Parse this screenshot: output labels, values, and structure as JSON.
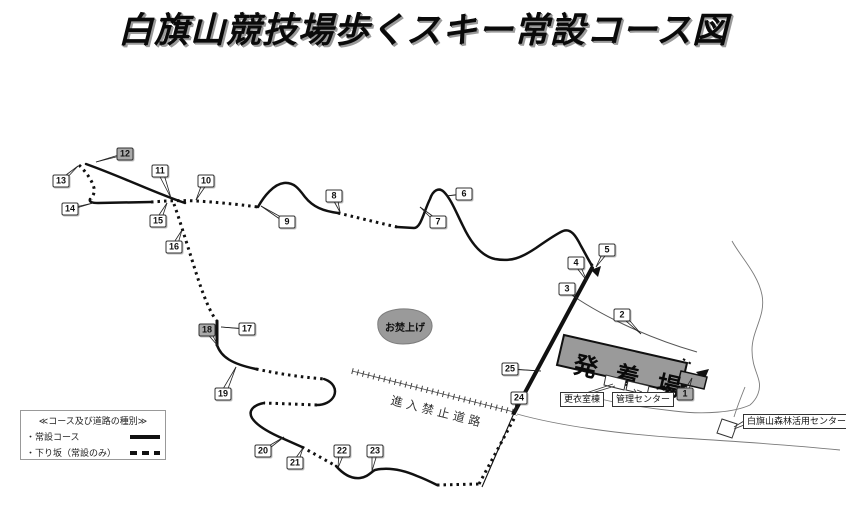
{
  "title": "白旗山競技場歩くスキー常設コース図",
  "legend": {
    "header": "≪コース及び道路の種別≫",
    "items": [
      {
        "label": "・常設コース",
        "style": "solid"
      },
      {
        "label": "・下り坂（常設のみ）",
        "style": "dashed"
      }
    ]
  },
  "labels": {
    "departure_area": "発 着 場",
    "bonfire": "お焚上げ",
    "no_entry_road": "進入禁止道路",
    "changing_room": "更衣室棟",
    "admin_center": "管理センター",
    "forest_center": "白旗山森林活用センター"
  },
  "colors": {
    "course": "#111111",
    "area_fill": "#9a9a9a",
    "marker_gray": "#a9a9a9",
    "road": "#7a7a7a"
  },
  "markers": [
    {
      "n": 1,
      "x": 685,
      "y": 394,
      "filled": true,
      "ax": 692,
      "ay": 378
    },
    {
      "n": 2,
      "x": 622,
      "y": 315,
      "filled": false,
      "ax": 641,
      "ay": 334
    },
    {
      "n": 3,
      "x": 567,
      "y": 289,
      "filled": false,
      "ax": 578,
      "ay": 299
    },
    {
      "n": 4,
      "x": 576,
      "y": 263,
      "filled": false,
      "ax": 587,
      "ay": 281
    },
    {
      "n": 5,
      "x": 607,
      "y": 250,
      "filled": false,
      "ax": 596,
      "ay": 267
    },
    {
      "n": 6,
      "x": 464,
      "y": 194,
      "filled": false,
      "ax": 446,
      "ay": 196
    },
    {
      "n": 7,
      "x": 438,
      "y": 222,
      "filled": false,
      "ax": 420,
      "ay": 207
    },
    {
      "n": 8,
      "x": 334,
      "y": 196,
      "filled": false,
      "ax": 340,
      "ay": 212
    },
    {
      "n": 9,
      "x": 287,
      "y": 222,
      "filled": false,
      "ax": 261,
      "ay": 206
    },
    {
      "n": 10,
      "x": 206,
      "y": 181,
      "filled": false,
      "ax": 196,
      "ay": 200
    },
    {
      "n": 11,
      "x": 160,
      "y": 171,
      "filled": false,
      "ax": 171,
      "ay": 198
    },
    {
      "n": 12,
      "x": 125,
      "y": 154,
      "filled": true,
      "ax": 96,
      "ay": 162
    },
    {
      "n": 13,
      "x": 61,
      "y": 181,
      "filled": false,
      "ax": 78,
      "ay": 166
    },
    {
      "n": 14,
      "x": 70,
      "y": 209,
      "filled": false,
      "ax": 93,
      "ay": 203
    },
    {
      "n": 15,
      "x": 158,
      "y": 221,
      "filled": false,
      "ax": 167,
      "ay": 203
    },
    {
      "n": 16,
      "x": 174,
      "y": 247,
      "filled": false,
      "ax": 182,
      "ay": 230
    },
    {
      "n": 17,
      "x": 247,
      "y": 329,
      "filled": false,
      "ax": 221,
      "ay": 327
    },
    {
      "n": 18,
      "x": 207,
      "y": 330,
      "filled": true,
      "ax": 218,
      "ay": 346
    },
    {
      "n": 19,
      "x": 223,
      "y": 394,
      "filled": false,
      "ax": 236,
      "ay": 367
    },
    {
      "n": 20,
      "x": 263,
      "y": 451,
      "filled": false,
      "ax": 284,
      "ay": 437
    },
    {
      "n": 21,
      "x": 295,
      "y": 463,
      "filled": false,
      "ax": 303,
      "ay": 448
    },
    {
      "n": 22,
      "x": 342,
      "y": 451,
      "filled": false,
      "ax": 338,
      "ay": 468
    },
    {
      "n": 23,
      "x": 375,
      "y": 451,
      "filled": false,
      "ax": 372,
      "ay": 471
    },
    {
      "n": 24,
      "x": 519,
      "y": 398,
      "filled": false,
      "ax": 515,
      "ay": 412
    },
    {
      "n": 25,
      "x": 510,
      "y": 369,
      "filled": false,
      "ax": 541,
      "ay": 371
    }
  ]
}
